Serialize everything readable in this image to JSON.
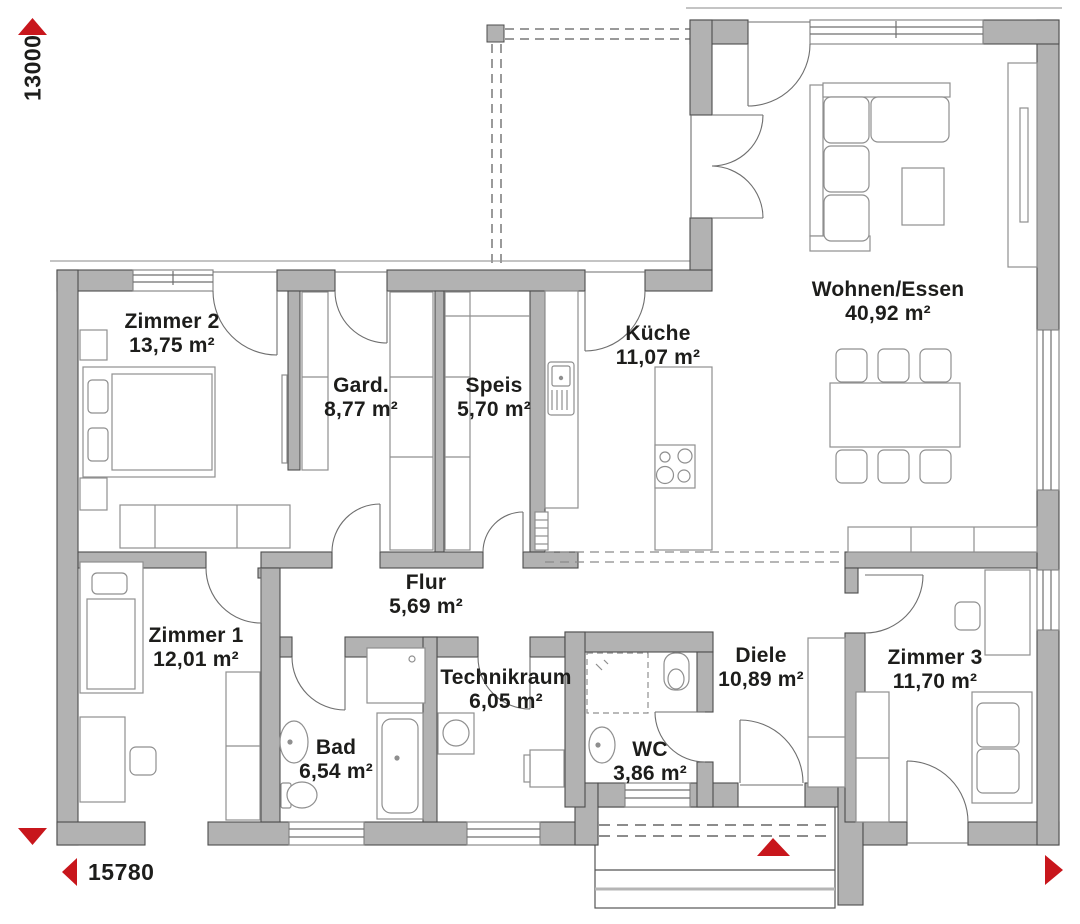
{
  "dimensions": {
    "horizontal": "15780",
    "vertical": "13000"
  },
  "rooms": [
    {
      "id": "zimmer2",
      "name": "Zimmer 2",
      "area": "13,75 m²"
    },
    {
      "id": "gard",
      "name": "Gard.",
      "area": "8,77 m²"
    },
    {
      "id": "speis",
      "name": "Speis",
      "area": "5,70 m²"
    },
    {
      "id": "kueche",
      "name": "Küche",
      "area": "11,07 m²"
    },
    {
      "id": "wohnen_essen",
      "name": "Wohnen/Essen",
      "area": "40,92 m²"
    },
    {
      "id": "flur",
      "name": "Flur",
      "area": "5,69 m²"
    },
    {
      "id": "zimmer1",
      "name": "Zimmer 1",
      "area": "12,01 m²"
    },
    {
      "id": "bad",
      "name": "Bad",
      "area": "6,54 m²"
    },
    {
      "id": "technikraum",
      "name": "Technikraum",
      "area": "6,05 m²"
    },
    {
      "id": "wc",
      "name": "WC",
      "area": "3,86 m²"
    },
    {
      "id": "diele",
      "name": "Diele",
      "area": "10,89 m²"
    },
    {
      "id": "zimmer3",
      "name": "Zimmer 3",
      "area": "11,70 m²"
    }
  ],
  "colors": {
    "wall": "#b2b2b2",
    "accent_red": "#c8161c",
    "text": "#1d1d1b"
  }
}
